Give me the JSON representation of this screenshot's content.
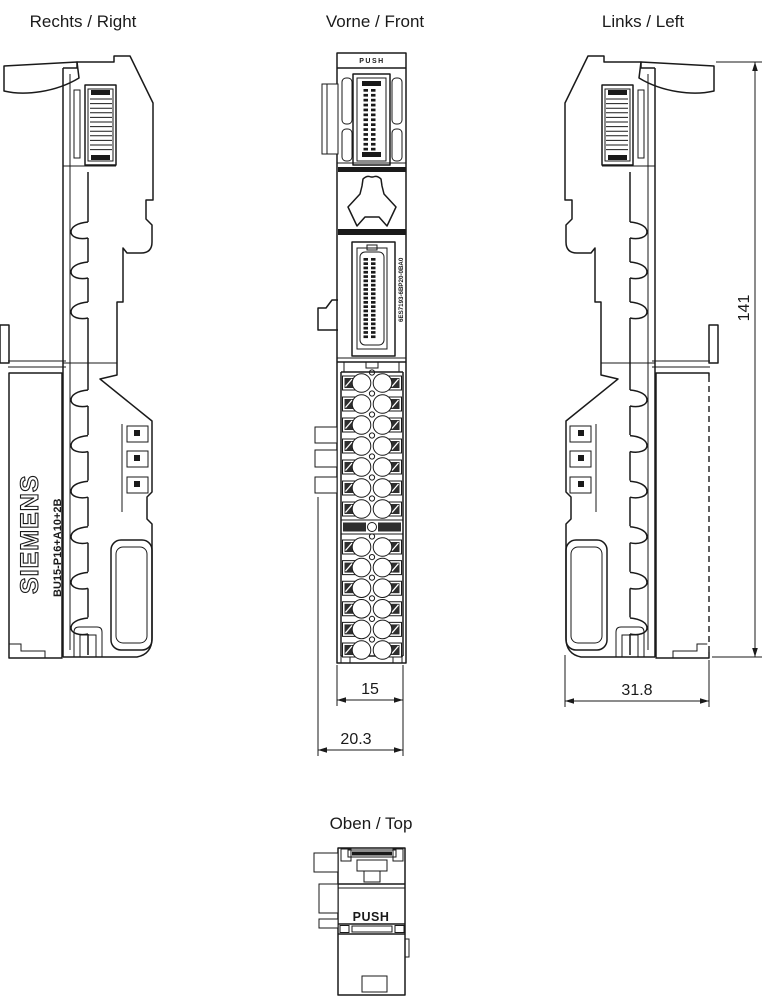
{
  "drawing": {
    "background": "#ffffff",
    "line_color": "#1a1a1a"
  },
  "views": {
    "right": {
      "label": "Rechts / Right",
      "brand": "SIEMENS",
      "model": "BU15-P16+A10+2B"
    },
    "front": {
      "label": "Vorne / Front",
      "article_number": "6ES7193-6BP20-0BA0",
      "top_button_label": "PUSH"
    },
    "left": {
      "label": "Links / Left"
    },
    "top": {
      "label": "Oben / Top",
      "button_label": "PUSH"
    }
  },
  "dimensions": {
    "height": "141",
    "terminal_width": "15",
    "total_front_width": "20.3",
    "side_depth": "31.8"
  }
}
